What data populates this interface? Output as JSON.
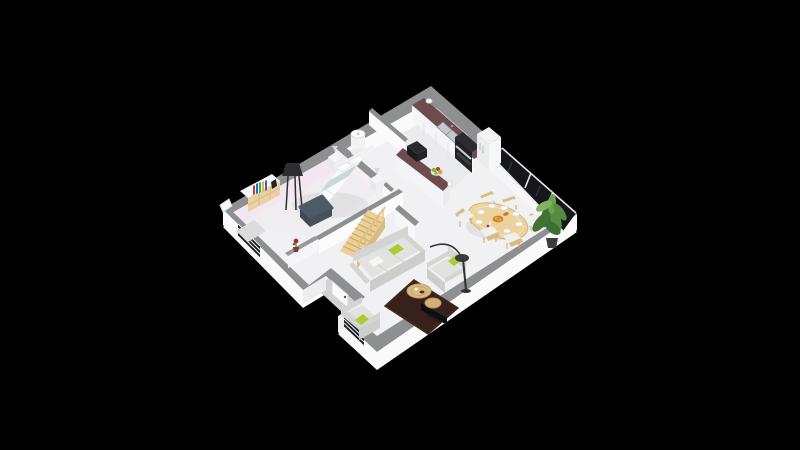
{
  "scene": {
    "kind": "isometric-3d-floor-plan-render",
    "background": "#000000",
    "inventory": {
      "rooms": [
        "bedroom",
        "bathroom",
        "hallway-stairs",
        "kitchen",
        "living-dining",
        "entrance-porch"
      ],
      "bedroom": [
        "double-bed",
        "headboard",
        "pillows",
        "teal-throw",
        "foot-bench",
        "nightstand-left",
        "nightstand-right",
        "dresser",
        "books-row",
        "black-floor-lamp",
        "wall-mirror",
        "window-blinds",
        "gray-rug"
      ],
      "bathroom": [
        "shower-column"
      ],
      "hallway": [
        "wood-staircase",
        "stair-railing",
        "half-wall",
        "red-flower-pot",
        "understair-closet"
      ],
      "kitchen": [
        "wall-counter",
        "double-sink",
        "oven-column",
        "refrigerator",
        "window-over-sink",
        "island-bar",
        "microwave",
        "fruit-bowl",
        "paper-towel-roll",
        "jar"
      ],
      "dining": [
        "oval-wood-table",
        "chair-1",
        "chair-2",
        "chair-3",
        "chair-4",
        "chair-5",
        "chair-6",
        "plates-x8",
        "bread-basket",
        "croissant",
        "jam"
      ],
      "living": [
        "three-seat-sofa",
        "armchair-right",
        "armchair-bottom",
        "lime-cushions",
        "white-cushion",
        "brown-rug",
        "round-coffee-table-large",
        "round-coffee-table-small",
        "tv-panel",
        "arc-floor-lamp"
      ],
      "exterior": [
        "entrance-porch",
        "front-door",
        "living-window",
        "bedroom-window",
        "glazed-bay-windows",
        "potted-plant"
      ]
    }
  },
  "colors": {
    "background": "#000000",
    "wallTop": "#8d8f91",
    "wallFace": "#fafafb",
    "wallFaceShade": "#ededf0",
    "bedroomWall": "#f2e6f0",
    "floorMain": "#f1f1f3",
    "floorKitchen": "#eaebee",
    "floorBedroom": "#f0edf1",
    "porchFloor": "#d2d2d4",
    "counterTop": "#6e4b4d",
    "cabinetFace": "#f5f5f7",
    "tableWood": "#ecd29c",
    "chairWood": "#d9bc85",
    "stairWood": "#ecd096",
    "dresserWood": "#ead0a2",
    "coffeeWood": "#dcba84",
    "lime": "#a7cd32",
    "sofaSeat": "#e2e3e0",
    "sofaBack": "#d4d5d2",
    "sofaFront": "#cdcecb",
    "rugBrown": "#38211b",
    "benchSlate": "#4e5a66",
    "tealThrow": "#c6d8d8",
    "glassDark": "#15171b",
    "steel": "#c3c8cd",
    "applianceDark": "#232327",
    "fridgeWhite": "#f3f4f4",
    "plantDark": "#3f6f33",
    "plantMid": "#578c3f",
    "plantLight": "#83b362",
    "flowerRed": "#c9263a",
    "fruitGreen": "#7ab530",
    "fruitRed": "#c43b2a",
    "foodOrange": "#d9912f"
  }
}
